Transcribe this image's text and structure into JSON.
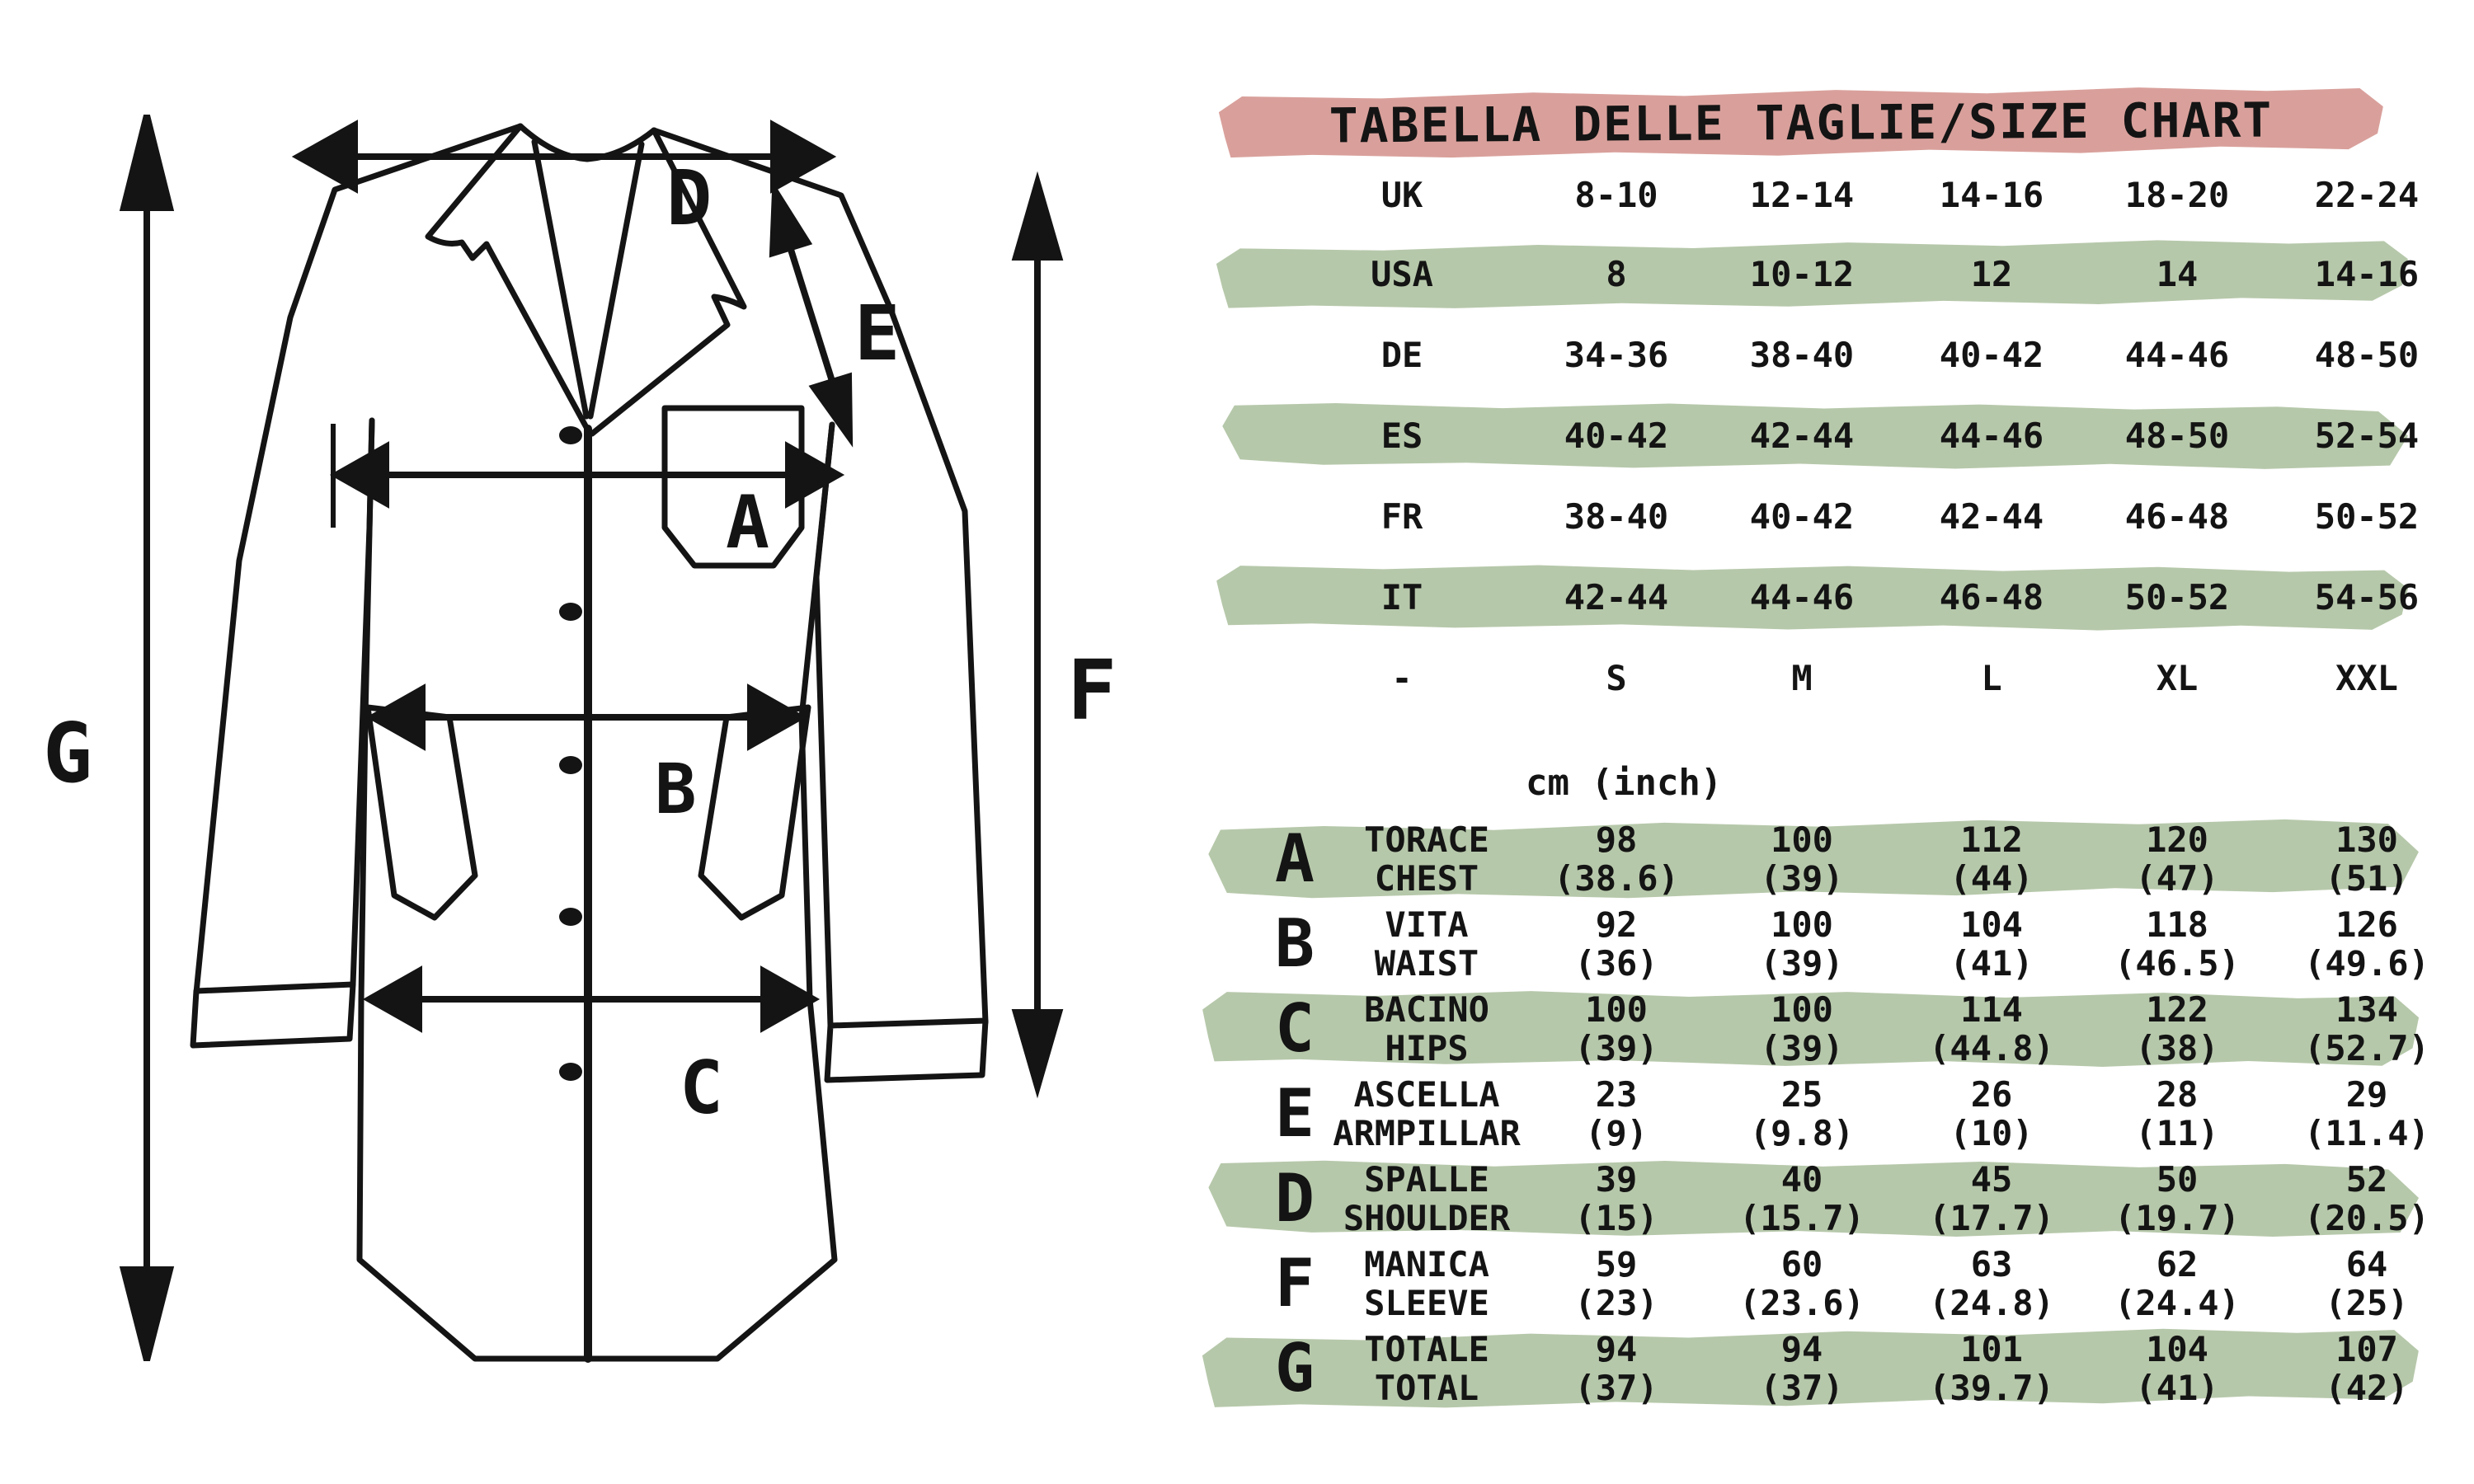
{
  "title": "TABELLA DELLE TAGLIE/SIZE CHART",
  "units_label": "cm (inch)",
  "colors": {
    "pink": "#d9a09b",
    "green": "#b6c8aa",
    "ink": "#141414"
  },
  "size_table": {
    "rows": [
      {
        "label": "UK",
        "highlight": false,
        "values": [
          "8-10",
          "12-14",
          "14-16",
          "18-20",
          "22-24"
        ]
      },
      {
        "label": "USA",
        "highlight": true,
        "values": [
          "8",
          "10-12",
          "12",
          "14",
          "14-16"
        ]
      },
      {
        "label": "DE",
        "highlight": false,
        "values": [
          "34-36",
          "38-40",
          "40-42",
          "44-46",
          "48-50"
        ]
      },
      {
        "label": "ES",
        "highlight": true,
        "values": [
          "40-42",
          "42-44",
          "44-46",
          "48-50",
          "52-54"
        ]
      },
      {
        "label": "FR",
        "highlight": false,
        "values": [
          "38-40",
          "40-42",
          "42-44",
          "46-48",
          "50-52"
        ]
      },
      {
        "label": "IT",
        "highlight": true,
        "values": [
          "42-44",
          "44-46",
          "46-48",
          "50-52",
          "54-56"
        ]
      },
      {
        "label": "-",
        "highlight": false,
        "values": [
          "S",
          "M",
          "L",
          "XL",
          "XXL"
        ]
      }
    ]
  },
  "measurement_table": {
    "rows": [
      {
        "letter": "A",
        "label_it": "TORACE",
        "label_en": "CHEST",
        "highlight": true,
        "cm": [
          "98",
          "100",
          "112",
          "120",
          "130"
        ],
        "inch": [
          "(38.6)",
          "(39)",
          "(44)",
          "(47)",
          "(51)"
        ]
      },
      {
        "letter": "B",
        "label_it": "VITA",
        "label_en": "WAIST",
        "highlight": false,
        "cm": [
          "92",
          "100",
          "104",
          "118",
          "126"
        ],
        "inch": [
          "(36)",
          "(39)",
          "(41)",
          "(46.5)",
          "(49.6)"
        ]
      },
      {
        "letter": "C",
        "label_it": "BACINO",
        "label_en": "HIPS",
        "highlight": true,
        "cm": [
          "100",
          "100",
          "114",
          "122",
          "134"
        ],
        "inch": [
          "(39)",
          "(39)",
          "(44.8)",
          "(38)",
          "(52.7)"
        ]
      },
      {
        "letter": "E",
        "label_it": "ASCELLA",
        "label_en": "ARMPILLAR",
        "highlight": false,
        "cm": [
          "23",
          "25",
          "26",
          "28",
          "29"
        ],
        "inch": [
          "(9)",
          "(9.8)",
          "(10)",
          "(11)",
          "(11.4)"
        ]
      },
      {
        "letter": "D",
        "label_it": "SPALLE",
        "label_en": "SHOULDER",
        "highlight": true,
        "cm": [
          "39",
          "40",
          "45",
          "50",
          "52"
        ],
        "inch": [
          "(15)",
          "(15.7)",
          "(17.7)",
          "(19.7)",
          "(20.5)"
        ]
      },
      {
        "letter": "F",
        "label_it": "MANICA",
        "label_en": "SLEEVE",
        "highlight": false,
        "cm": [
          "59",
          "60",
          "63",
          "62",
          "64"
        ],
        "inch": [
          "(23)",
          "(23.6)",
          "(24.8)",
          "(24.4)",
          "(25)"
        ]
      },
      {
        "letter": "G",
        "label_it": "TOTALE",
        "label_en": "TOTAL",
        "highlight": true,
        "cm": [
          "94",
          "94",
          "101",
          "104",
          "107"
        ],
        "inch": [
          "(37)",
          "(37)",
          "(39.7)",
          "(41)",
          "(42)"
        ]
      }
    ]
  },
  "diagram": {
    "letters": {
      "a": "A",
      "b": "B",
      "c": "C",
      "d": "D",
      "e": "E",
      "f": "F",
      "g": "G"
    }
  }
}
